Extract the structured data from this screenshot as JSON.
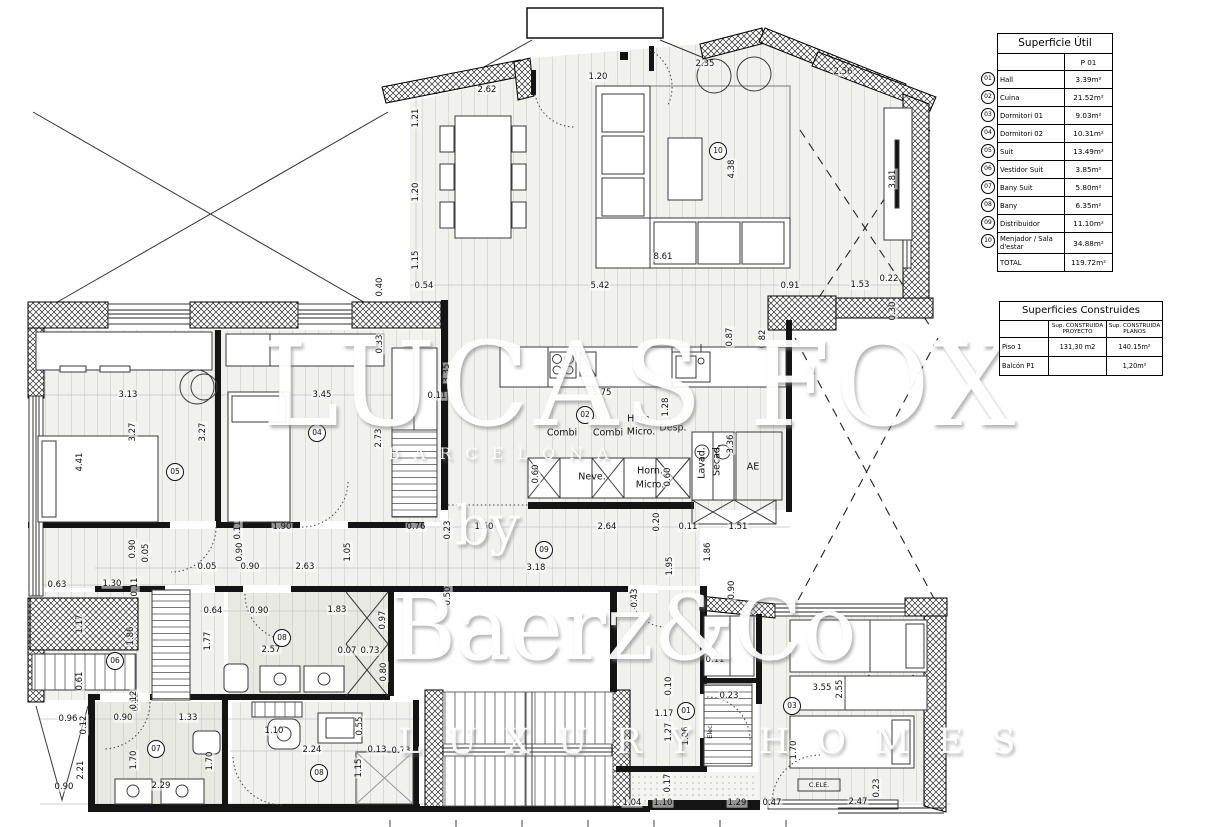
{
  "tables": {
    "superficie_util": {
      "title": "Superficie Útil",
      "col_header": "P 01",
      "rows": [
        {
          "num": "01",
          "label": "Hall",
          "value": "3.39m²"
        },
        {
          "num": "02",
          "label": "Cuina",
          "value": "21.52m²"
        },
        {
          "num": "03",
          "label": "Dormitori 01",
          "value": "9.03m²"
        },
        {
          "num": "04",
          "label": "Dormitori 02",
          "value": "10.31m²"
        },
        {
          "num": "05",
          "label": "Suit",
          "value": "13.49m²"
        },
        {
          "num": "06",
          "label": "Vestidor Suit",
          "value": "3.85m²"
        },
        {
          "num": "07",
          "label": "Bany Suit",
          "value": "5.80m²"
        },
        {
          "num": "08",
          "label": "Bany",
          "value": "6.35m²"
        },
        {
          "num": "09",
          "label": "Distribuidor",
          "value": "11.10m²"
        },
        {
          "num": "10",
          "label": "Menjador / Sala d'estar",
          "value": "34.88m²"
        },
        {
          "num": "",
          "label": "TOTAL",
          "value": "119.72m²"
        }
      ]
    },
    "superficies_construides": {
      "title": "Superficies Construides",
      "col_headers": {
        "proyecto": "Sup. CONSTRUIDA PROYECTO",
        "planos": "Sup. CONSTRUIDA PLANOS"
      },
      "rows": [
        {
          "label": "Piso 1",
          "proyecto": "131,30 m2",
          "planos": "140.15m²"
        },
        {
          "label": "Balcón P1",
          "proyecto": "",
          "planos": "1,20m²"
        }
      ]
    }
  },
  "watermark": {
    "big": "LUCAS FOX",
    "subtitle": "BARCELONA",
    "by": "by",
    "brand": "Baerz&Co",
    "tagline": "LUXURY HOMES"
  },
  "plan": {
    "room_badges": [
      {
        "num": "01",
        "x": 686,
        "y": 711
      },
      {
        "num": "02",
        "x": 585,
        "y": 415
      },
      {
        "num": "03",
        "x": 792,
        "y": 706
      },
      {
        "num": "04",
        "x": 317,
        "y": 433
      },
      {
        "num": "05",
        "x": 175,
        "y": 472
      },
      {
        "num": "06",
        "x": 115,
        "y": 661
      },
      {
        "num": "07",
        "x": 156,
        "y": 749
      },
      {
        "num": "08",
        "x": 282,
        "y": 638
      },
      {
        "num": "08",
        "x": 319,
        "y": 773
      },
      {
        "num": "09",
        "x": 544,
        "y": 550
      },
      {
        "num": "10",
        "x": 718,
        "y": 151
      }
    ],
    "labels": [
      {
        "t": "Combi",
        "x": 562,
        "y": 433
      },
      {
        "t": "Combi",
        "x": 608,
        "y": 433
      },
      {
        "t": "Horn.",
        "x": 640,
        "y": 419
      },
      {
        "t": "Micro.",
        "x": 641,
        "y": 432
      },
      {
        "t": "Desp.",
        "x": 673,
        "y": 428
      },
      {
        "t": "Neve.",
        "x": 592,
        "y": 477
      },
      {
        "t": "Horn.",
        "x": 650,
        "y": 471
      },
      {
        "t": "Micro.",
        "x": 650,
        "y": 485
      },
      {
        "t": "Lavad.",
        "x": 702,
        "y": 463,
        "v": true
      },
      {
        "t": "Secad.",
        "x": 717,
        "y": 460,
        "v": true
      },
      {
        "t": "AE",
        "x": 753,
        "y": 467
      },
      {
        "t": "C.ELE.",
        "x": 819,
        "y": 785,
        "s": true
      },
      {
        "t": "Elec.",
        "x": 710,
        "y": 731,
        "v": true,
        "s": true
      }
    ],
    "dimensions": [
      {
        "t": "2.62",
        "x": 487,
        "y": 90
      },
      {
        "t": "1.20",
        "x": 598,
        "y": 77
      },
      {
        "t": "2.35",
        "x": 705,
        "y": 64
      },
      {
        "t": "2.56",
        "x": 843,
        "y": 72
      },
      {
        "t": "1.21",
        "x": 416,
        "y": 118,
        "v": true
      },
      {
        "t": "1.20",
        "x": 416,
        "y": 192,
        "v": true
      },
      {
        "t": "1.15",
        "x": 416,
        "y": 260,
        "v": true
      },
      {
        "t": "0.54",
        "x": 424,
        "y": 286
      },
      {
        "t": "5.42",
        "x": 600,
        "y": 286
      },
      {
        "t": "8.61",
        "x": 663,
        "y": 257
      },
      {
        "t": "4.38",
        "x": 732,
        "y": 169,
        "v": true
      },
      {
        "t": "3.81",
        "x": 893,
        "y": 179,
        "v": true
      },
      {
        "t": "0.91",
        "x": 790,
        "y": 286
      },
      {
        "t": "1.53",
        "x": 860,
        "y": 285
      },
      {
        "t": "0.22",
        "x": 889,
        "y": 279
      },
      {
        "t": "0.40",
        "x": 380,
        "y": 287,
        "v": true
      },
      {
        "t": "0.33",
        "x": 380,
        "y": 344,
        "v": true
      },
      {
        "t": "3.35",
        "x": 447,
        "y": 373,
        "v": true
      },
      {
        "t": "0.87",
        "x": 730,
        "y": 337,
        "v": true
      },
      {
        "t": "0.82",
        "x": 763,
        "y": 339,
        "v": true
      },
      {
        "t": "0.30",
        "x": 893,
        "y": 311,
        "v": true
      },
      {
        "t": "5.75",
        "x": 602,
        "y": 393
      },
      {
        "t": "1.28",
        "x": 666,
        "y": 407,
        "v": true
      },
      {
        "t": "0.11",
        "x": 437,
        "y": 396
      },
      {
        "t": "2.73",
        "x": 379,
        "y": 438,
        "v": true
      },
      {
        "t": "3.36",
        "x": 731,
        "y": 444,
        "v": true
      },
      {
        "t": "0.60",
        "x": 536,
        "y": 474,
        "v": true
      },
      {
        "t": "0.60",
        "x": 668,
        "y": 477,
        "v": true
      },
      {
        "t": "3.13",
        "x": 128,
        "y": 395
      },
      {
        "t": "3.45",
        "x": 322,
        "y": 395
      },
      {
        "t": "3.27",
        "x": 133,
        "y": 432,
        "v": true
      },
      {
        "t": "3.27",
        "x": 203,
        "y": 432,
        "v": true
      },
      {
        "t": "4.41",
        "x": 80,
        "y": 462,
        "v": true
      },
      {
        "t": "1.90",
        "x": 282,
        "y": 527
      },
      {
        "t": "0.11",
        "x": 238,
        "y": 530,
        "v": true
      },
      {
        "t": "0.90",
        "x": 240,
        "y": 552,
        "v": true
      },
      {
        "t": "1.05",
        "x": 348,
        "y": 552,
        "v": true
      },
      {
        "t": "0.90",
        "x": 133,
        "y": 549,
        "v": true
      },
      {
        "t": "0.05",
        "x": 146,
        "y": 553,
        "v": true
      },
      {
        "t": "0.05",
        "x": 207,
        "y": 567
      },
      {
        "t": "0.90",
        "x": 250,
        "y": 567
      },
      {
        "t": "2.63",
        "x": 305,
        "y": 567
      },
      {
        "t": "0.76",
        "x": 416,
        "y": 527
      },
      {
        "t": "1.50",
        "x": 484,
        "y": 527
      },
      {
        "t": "2.64",
        "x": 607,
        "y": 527
      },
      {
        "t": "0.20",
        "x": 657,
        "y": 522,
        "v": true
      },
      {
        "t": "0.11",
        "x": 688,
        "y": 527
      },
      {
        "t": "1.51",
        "x": 738,
        "y": 527
      },
      {
        "t": "0.23",
        "x": 448,
        "y": 530,
        "v": true
      },
      {
        "t": "3.18",
        "x": 536,
        "y": 568
      },
      {
        "t": "1.95",
        "x": 670,
        "y": 566,
        "v": true
      },
      {
        "t": "1.86",
        "x": 708,
        "y": 552,
        "v": true
      },
      {
        "t": "0.50",
        "x": 448,
        "y": 596,
        "v": true
      },
      {
        "t": "0.43",
        "x": 635,
        "y": 598,
        "v": true
      },
      {
        "t": "0.90",
        "x": 732,
        "y": 590,
        "v": true
      },
      {
        "t": "0.63",
        "x": 57,
        "y": 585
      },
      {
        "t": "1.30",
        "x": 112,
        "y": 584
      },
      {
        "t": "0.11",
        "x": 135,
        "y": 587,
        "v": true
      },
      {
        "t": "1.17",
        "x": 80,
        "y": 624,
        "v": true
      },
      {
        "t": "1.86",
        "x": 131,
        "y": 636,
        "v": true
      },
      {
        "t": "0.61",
        "x": 80,
        "y": 681,
        "v": true
      },
      {
        "t": "0.12",
        "x": 136,
        "y": 702,
        "v": true
      },
      {
        "t": "0.64",
        "x": 213,
        "y": 611
      },
      {
        "t": "0.90",
        "x": 259,
        "y": 611
      },
      {
        "t": "1.83",
        "x": 337,
        "y": 610
      },
      {
        "t": "0.97",
        "x": 383,
        "y": 620,
        "v": true
      },
      {
        "t": "1.77",
        "x": 208,
        "y": 641,
        "v": true
      },
      {
        "t": "2.57",
        "x": 271,
        "y": 650
      },
      {
        "t": "0.07",
        "x": 347,
        "y": 651
      },
      {
        "t": "0.73",
        "x": 370,
        "y": 651
      },
      {
        "t": "0.80",
        "x": 384,
        "y": 672,
        "v": true
      },
      {
        "t": "0.96",
        "x": 68,
        "y": 719
      },
      {
        "t": "0.12",
        "x": 84,
        "y": 725,
        "v": true
      },
      {
        "t": "0.90",
        "x": 123,
        "y": 718
      },
      {
        "t": "1.33",
        "x": 188,
        "y": 718
      },
      {
        "t": "0.12",
        "x": 134,
        "y": 700,
        "v": true
      },
      {
        "t": "1.70",
        "x": 134,
        "y": 760,
        "v": true
      },
      {
        "t": "1.70",
        "x": 210,
        "y": 761,
        "v": true
      },
      {
        "t": "2.29",
        "x": 161,
        "y": 786
      },
      {
        "t": "2.21",
        "x": 81,
        "y": 770,
        "v": true
      },
      {
        "t": "0.90",
        "x": 64,
        "y": 787
      },
      {
        "t": "1.10",
        "x": 274,
        "y": 731
      },
      {
        "t": "0.55",
        "x": 360,
        "y": 726,
        "v": true
      },
      {
        "t": "2.24",
        "x": 312,
        "y": 750
      },
      {
        "t": "0.13",
        "x": 377,
        "y": 750
      },
      {
        "t": "0.73",
        "x": 401,
        "y": 751
      },
      {
        "t": "1.15",
        "x": 359,
        "y": 768,
        "v": true
      },
      {
        "t": "0.11",
        "x": 715,
        "y": 660
      },
      {
        "t": "0.10",
        "x": 669,
        "y": 686,
        "v": true
      },
      {
        "t": "0.23",
        "x": 729,
        "y": 696
      },
      {
        "t": "1.17",
        "x": 664,
        "y": 714
      },
      {
        "t": "1.27",
        "x": 669,
        "y": 732,
        "v": true
      },
      {
        "t": "1.06",
        "x": 686,
        "y": 736,
        "v": true
      },
      {
        "t": "0.17",
        "x": 668,
        "y": 783,
        "v": true
      },
      {
        "t": "1.04",
        "x": 632,
        "y": 803
      },
      {
        "t": "1.10",
        "x": 663,
        "y": 803
      },
      {
        "t": "1.29",
        "x": 737,
        "y": 803
      },
      {
        "t": "0.47",
        "x": 772,
        "y": 803
      },
      {
        "t": "3.55",
        "x": 822,
        "y": 688
      },
      {
        "t": "2.55",
        "x": 840,
        "y": 689,
        "v": true
      },
      {
        "t": "1.70",
        "x": 794,
        "y": 750,
        "v": true
      },
      {
        "t": "2.47",
        "x": 858,
        "y": 802
      },
      {
        "t": "0.23",
        "x": 877,
        "y": 788,
        "v": true
      }
    ]
  }
}
